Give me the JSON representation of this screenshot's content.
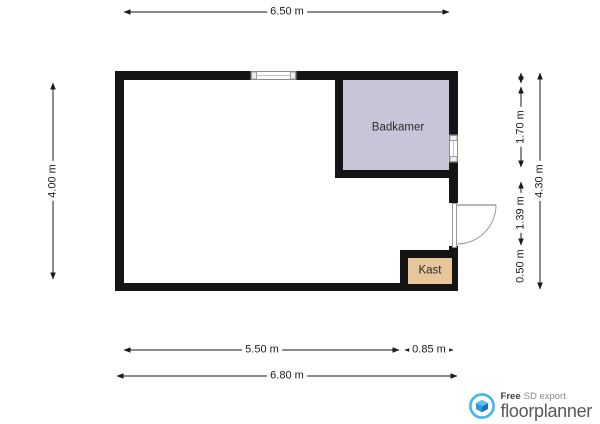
{
  "plan": {
    "rooms": {
      "badkamer": "Badkamer",
      "kast": "Kast"
    },
    "dims": {
      "top": "6.50 m",
      "left": "4.00 m",
      "right_seg1": "1.70 m",
      "right_seg2": "1.39 m",
      "right_seg3": "0.50 m",
      "right_total": "4.30 m",
      "bottom_seg1": "5.50 m",
      "bottom_seg2": "0.85 m",
      "bottom_total": "6.80 m"
    },
    "colors": {
      "wall": "#141414",
      "badkamer_fill": "#c6c6d8",
      "kast_fill": "#e7c79a",
      "dim_line": "#1a1a1a",
      "brand_blue": "#41b6ea",
      "brand_blue_dark": "#1e6fc0"
    }
  },
  "branding": {
    "free": "Free",
    "sd_export": "SD export",
    "name": "floorplanner"
  }
}
